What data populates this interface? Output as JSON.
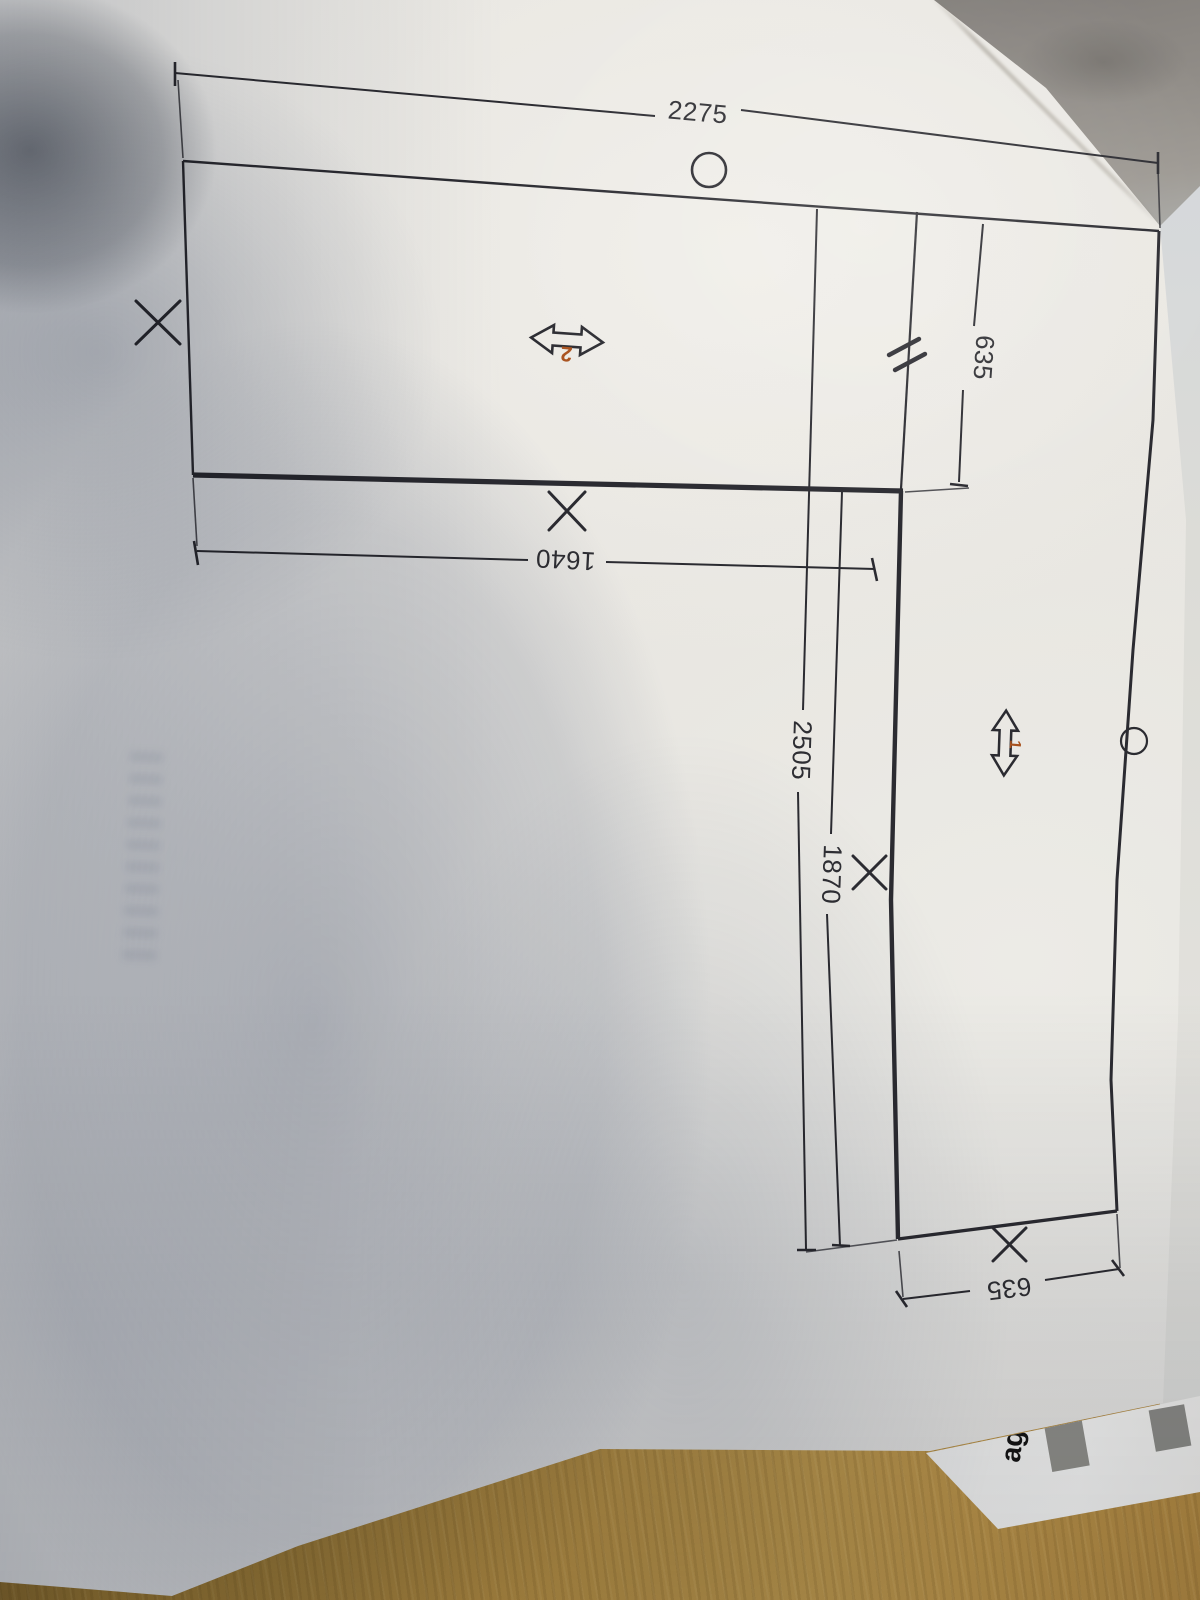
{
  "drawing": {
    "dim_total_width": "2275",
    "dim_piece2_length": "1640",
    "dim_piece1_width_top": "635",
    "dim_piece1_total_length": "2505",
    "dim_piece1_inner_length": "1870",
    "dim_piece1_width_bottom": "635",
    "piece2_label": "2",
    "piece1_label": "1",
    "accent_color": "#a8511d",
    "line_color": "#2b2b31"
  },
  "under_sheet": {
    "visible_text": "ag."
  },
  "icons": {
    "x_mark": "✕",
    "circle_mark": "○",
    "joint_mark": "//",
    "grain_arrow_horizontal": "↔",
    "grain_arrow_vertical": "↕"
  }
}
